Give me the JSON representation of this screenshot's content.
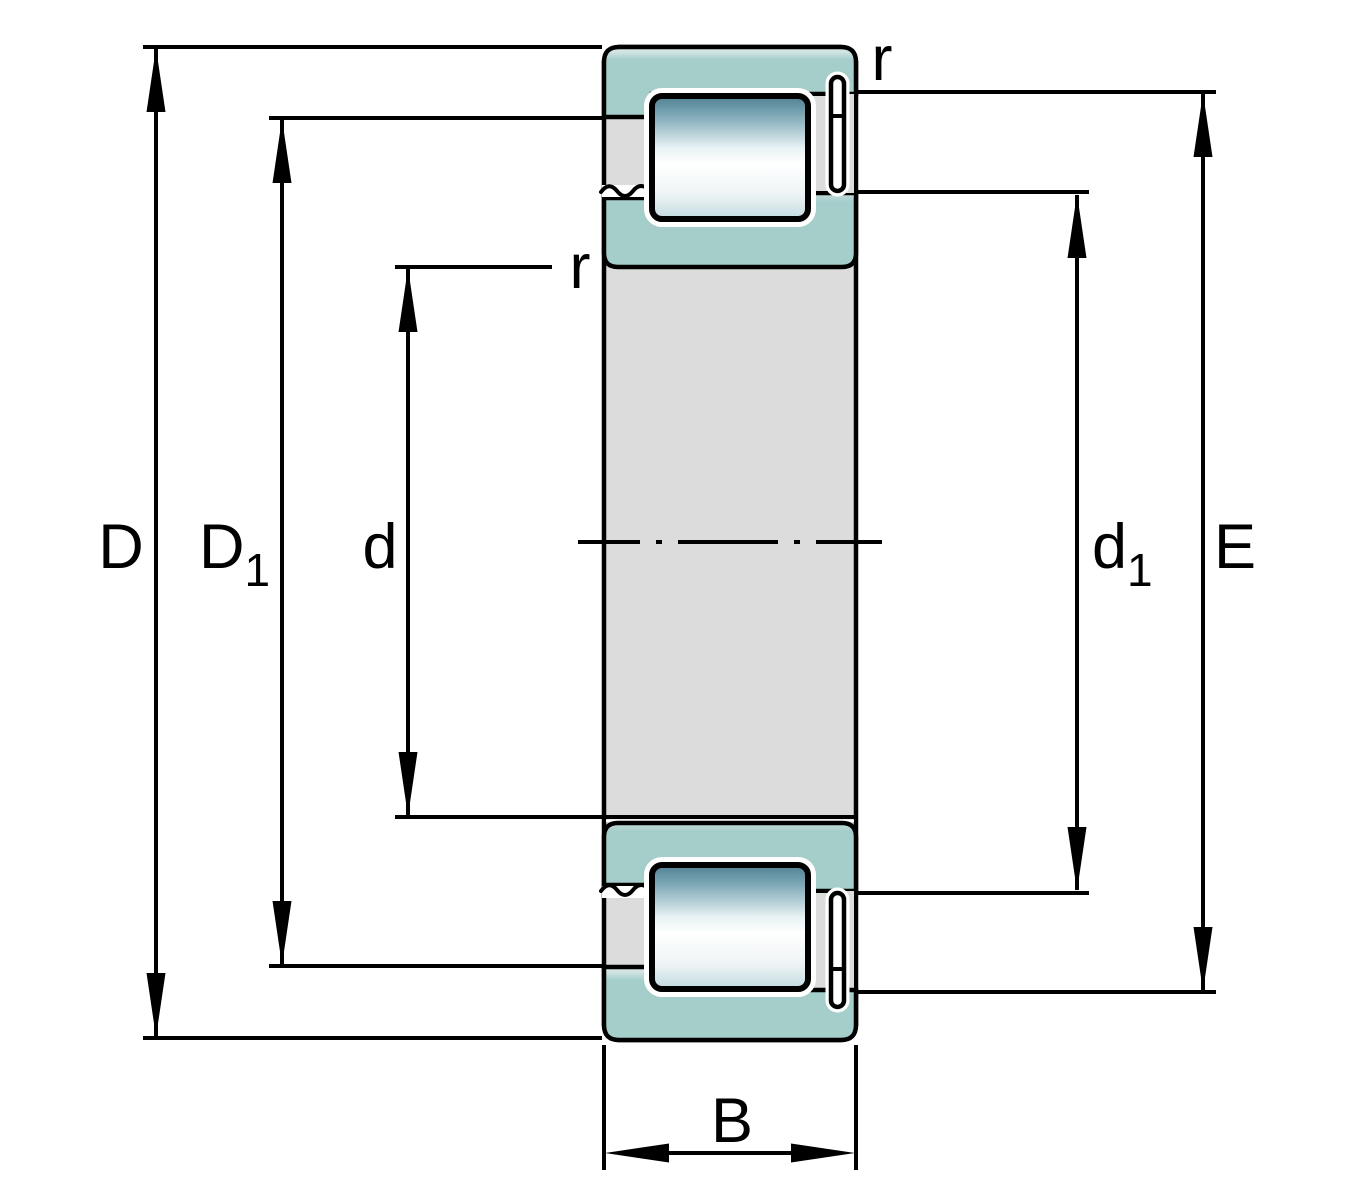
{
  "drawing": {
    "kind": "bearing-cross-section",
    "description": "Single row cylindrical roller bearing section with dimension lines"
  },
  "labels": {
    "outer_diameter": {
      "main": "D",
      "sub": ""
    },
    "outer_shoulder": {
      "main": "D",
      "sub": "1"
    },
    "bore_diameter": {
      "main": "d",
      "sub": ""
    },
    "inner_shoulder": {
      "main": "d",
      "sub": "1"
    },
    "raceway_diameter": {
      "main": "E",
      "sub": ""
    },
    "width": {
      "main": "B",
      "sub": ""
    },
    "chamfer_radius_top": {
      "text": "r"
    },
    "chamfer_radius_left": {
      "text": "r"
    }
  },
  "colors": {
    "ring_teal": "#a5cecb",
    "ring_highlight": "#d2e4e3",
    "steel_gray": "#dcdcdc",
    "roller_dark": "#4e8093",
    "roller_light": "#ffffff",
    "line": "#000000"
  }
}
